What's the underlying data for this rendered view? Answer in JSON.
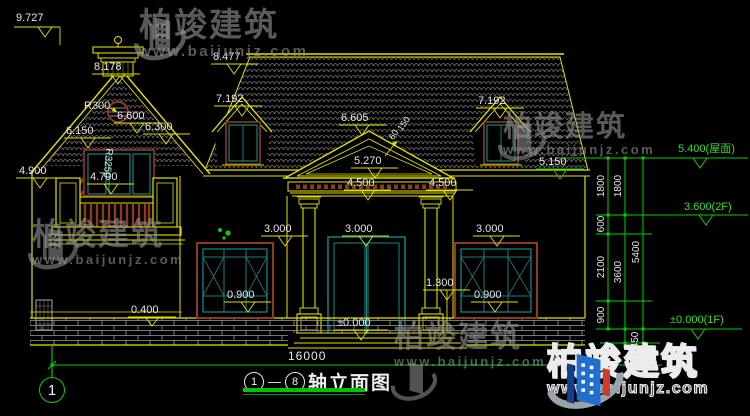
{
  "watermark": {
    "brand": "柏竣建筑",
    "url": "www.baijunjz.com"
  },
  "figure": {
    "axis_from": "1",
    "dash": "—",
    "axis_to": "8",
    "title": "轴立面图",
    "overall_dimension": "16000",
    "axis_bubble_left": "1"
  },
  "labels": {
    "chimney_top": "9.727",
    "left_ridge": "8.178",
    "main_ridge": "8.477",
    "dormer_left": "7.192",
    "dormer_right": "7.192",
    "porch_ridge": "6.605",
    "vent_radius": "R300",
    "gable_center": "6.600",
    "gable_left": "6.150",
    "gable_right": "6.300",
    "arch_radius": "R3250",
    "left_eave": "4.900",
    "balcony_top": "4.700",
    "pediment_inner": "5.270",
    "porch_left": "4.500",
    "porch_right": "4.500",
    "right_eave": "5.150",
    "win_top_left": "3.000",
    "win_top_center": "3.000",
    "win_top_right": "3.000",
    "sill_left": "0.900",
    "sill_right": "0.900",
    "column_base": "1.300",
    "plinth": "0.400",
    "ground_floor": "±0.000",
    "slope_a": "150",
    "slope_b": "60"
  },
  "right_chain": {
    "c1_1800": "1800",
    "c2_1800": "1800",
    "c1_600": "600",
    "c1_2100": "2100",
    "c2_3600": "3600",
    "c1_900": "900",
    "c3_5400": "5400",
    "c3_450": "450",
    "roof_level": "5.400(屋面)",
    "second_floor": "3.600(2F)",
    "first_floor": "±0.000(1F)"
  }
}
